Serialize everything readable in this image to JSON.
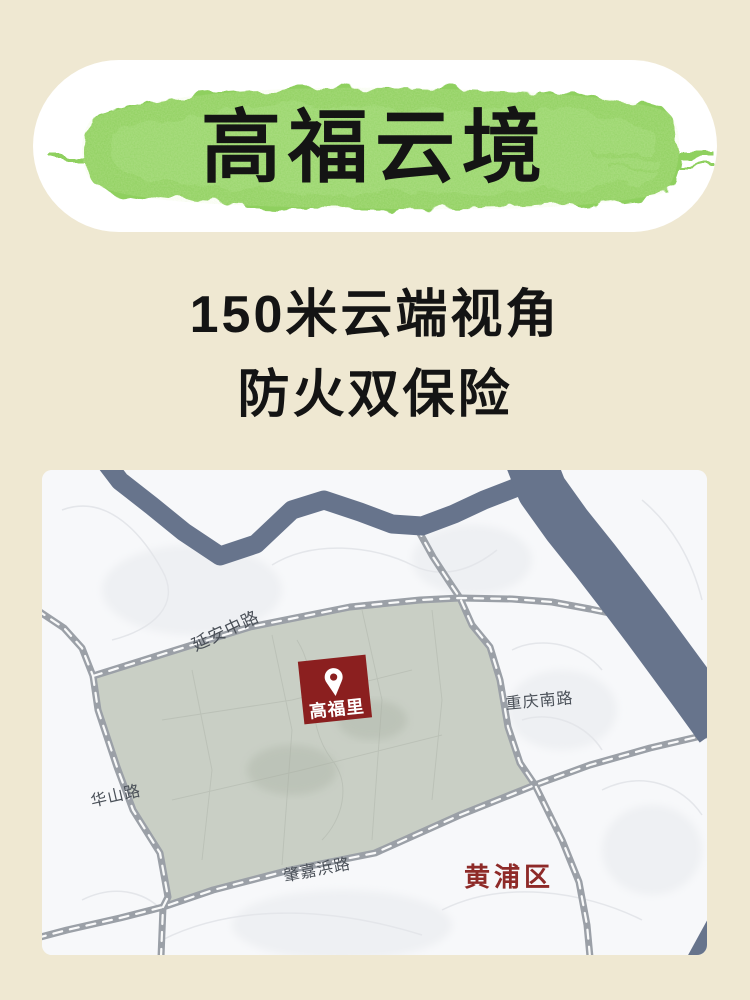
{
  "banner": {
    "title": "高福云境",
    "brush_color": "#8fd05f"
  },
  "subtitle": {
    "line1": "150米云端视角",
    "line2": "防火双保险"
  },
  "map": {
    "pin": {
      "label": "高福里",
      "color": "#8b1f1f"
    },
    "district_label": "黄浦区",
    "roads": [
      {
        "name": "延安中路"
      },
      {
        "name": "华山路"
      },
      {
        "name": "重庆南路"
      },
      {
        "name": "肇嘉浜路"
      }
    ],
    "colors": {
      "water": "#67748c",
      "road": "#9ba0a7",
      "road_dash": "#ffffff",
      "highlight_area": "#c9cfc5",
      "map_background": "#f7f8fa",
      "district_text": "#8e2a28",
      "road_label_text": "#4a5058"
    }
  },
  "page": {
    "background_color": "#efe8d2"
  }
}
